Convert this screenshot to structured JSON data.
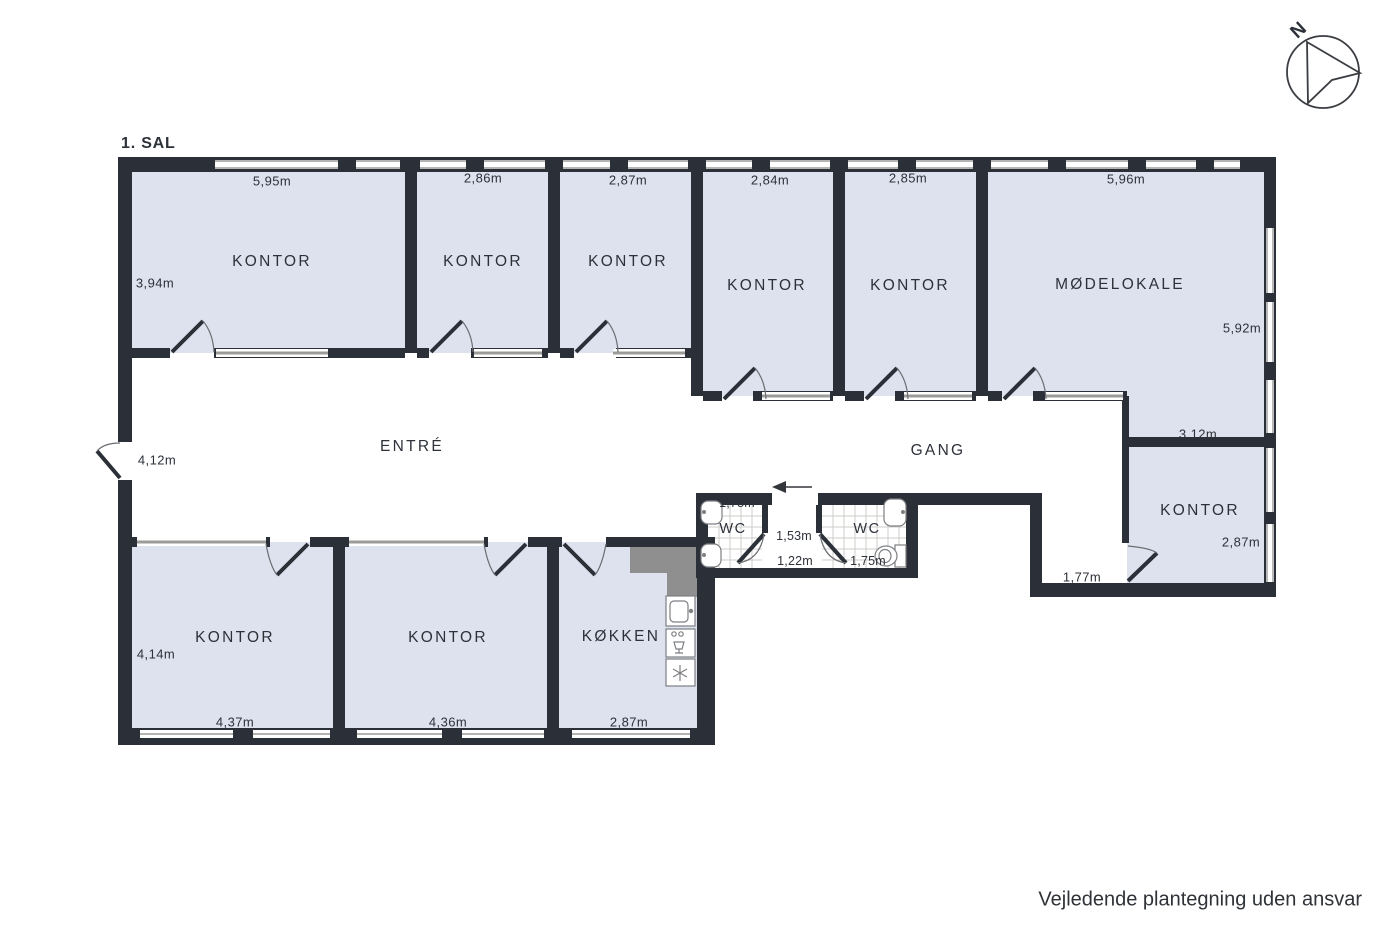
{
  "title": "1. SAL",
  "disclaimer": "Vejledende plantegning uden ansvar",
  "compass_label": "N",
  "colors": {
    "wall": "#2b2f37",
    "room_fill": "#dde2ee",
    "window": "#9b9b99",
    "shaft": "#8f8f8f"
  },
  "rooms": [
    {
      "name": "KONTOR",
      "dim_top": "5,95m",
      "dim_left": "3,94m"
    },
    {
      "name": "KONTOR",
      "dim_top": "2,86m"
    },
    {
      "name": "KONTOR",
      "dim_top": "2,87m"
    },
    {
      "name": "KONTOR",
      "dim_top": "2,84m"
    },
    {
      "name": "KONTOR",
      "dim_top": "2,85m"
    },
    {
      "name": "MØDELOKALE",
      "dim_top": "5,96m",
      "dim_right": "5,92m",
      "dim_bottom": "3,12m"
    },
    {
      "name": "ENTRÉ",
      "dim_left": "4,12m"
    },
    {
      "name": "GANG"
    },
    {
      "name": "WC",
      "dim_top": "1,78m"
    },
    {
      "name": "WC",
      "dim_bottom": "1,75m"
    },
    {
      "name": "KONTOR",
      "dim_right": "2,87m",
      "dim_passage": "1,77m"
    },
    {
      "name": "KONTOR",
      "dim_left": "4,14m",
      "dim_bottom": "4,37m"
    },
    {
      "name": "KONTOR",
      "dim_bottom": "4,36m"
    },
    {
      "name": "KØKKEN",
      "dim_bottom": "2,87m"
    }
  ],
  "vestibule": {
    "dim_top": "1,53m",
    "dim_bottom": "1,22m"
  }
}
